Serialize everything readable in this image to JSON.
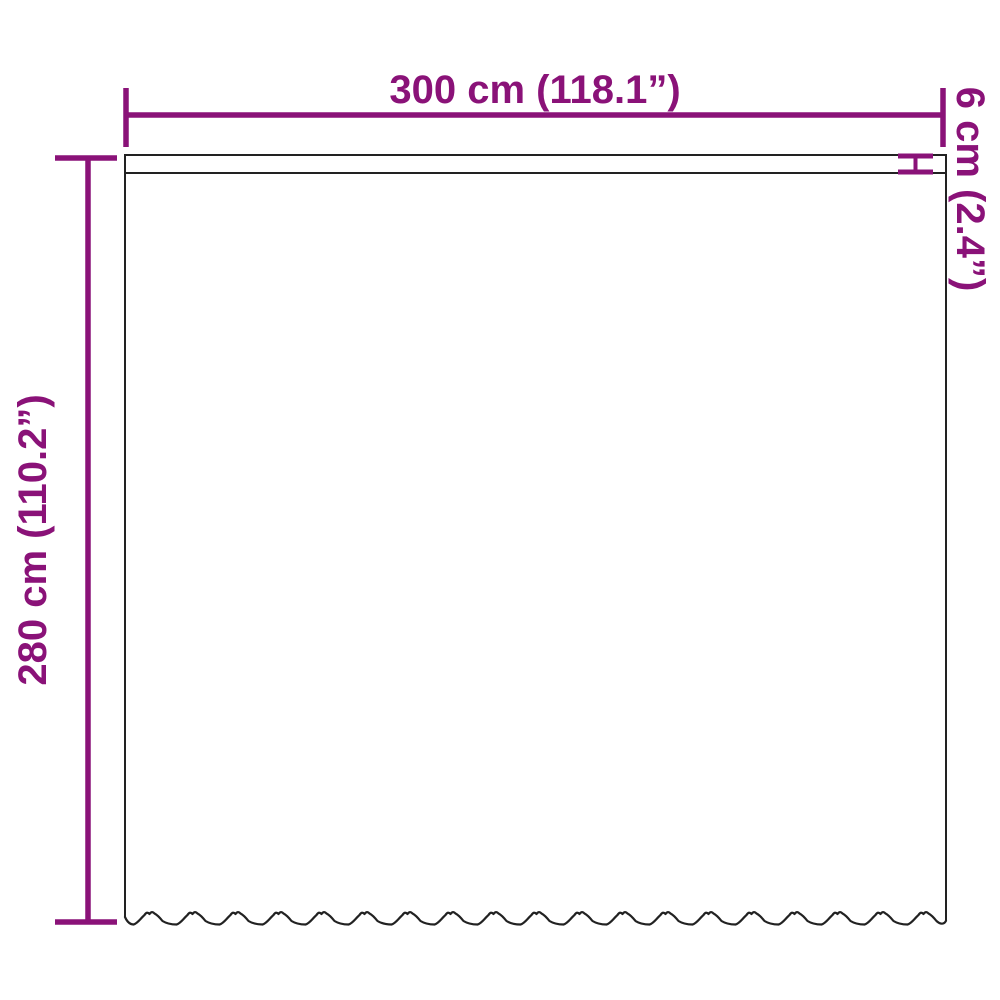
{
  "diagram": {
    "width_label": "300 cm (118.1”)",
    "height_label": "280 cm (110.2”)",
    "strip_label": "6 cm (2.4”)"
  },
  "colors": {
    "accent": "#8A1278",
    "outline": "#222222",
    "background": "#FFFFFF"
  }
}
